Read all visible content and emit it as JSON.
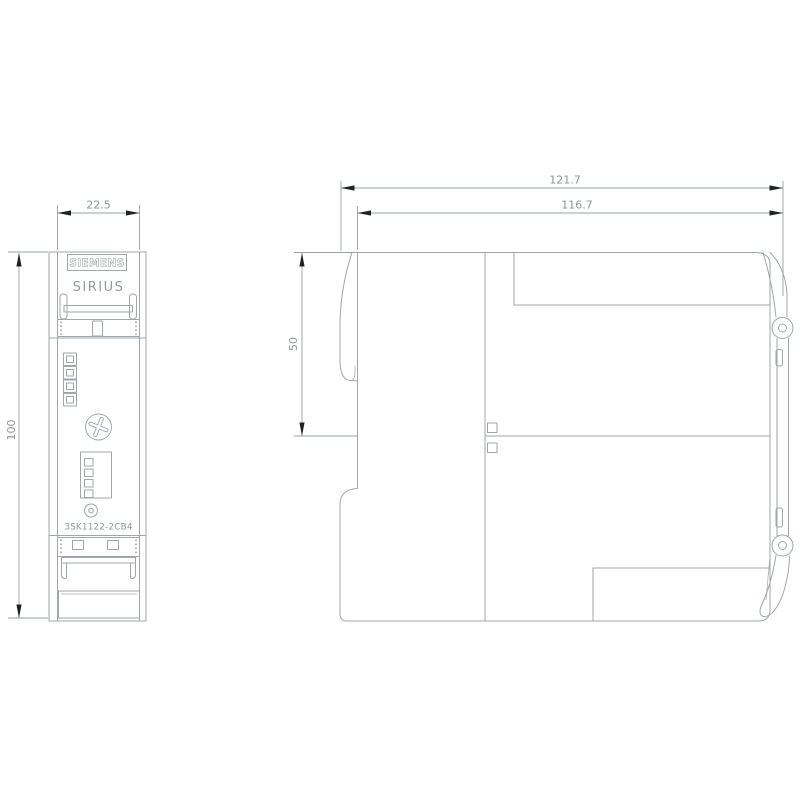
{
  "product": {
    "brand": "SIEMENS",
    "series": "SIRIUS",
    "part_number": "3SK1122-2CB4"
  },
  "drawing_type": "dimension-drawing-front-and-side-view",
  "dimensions_mm": {
    "front_width": "22.5",
    "height": "100",
    "upper_depth": "50",
    "total_depth": "121.7",
    "body_depth": "116.7"
  },
  "colors": {
    "background": "#ffffff",
    "outline": "#a0a6ab",
    "dimension_line": "#9aa0a6",
    "dimension_text": "#8e959b",
    "arrow": "#202224"
  }
}
